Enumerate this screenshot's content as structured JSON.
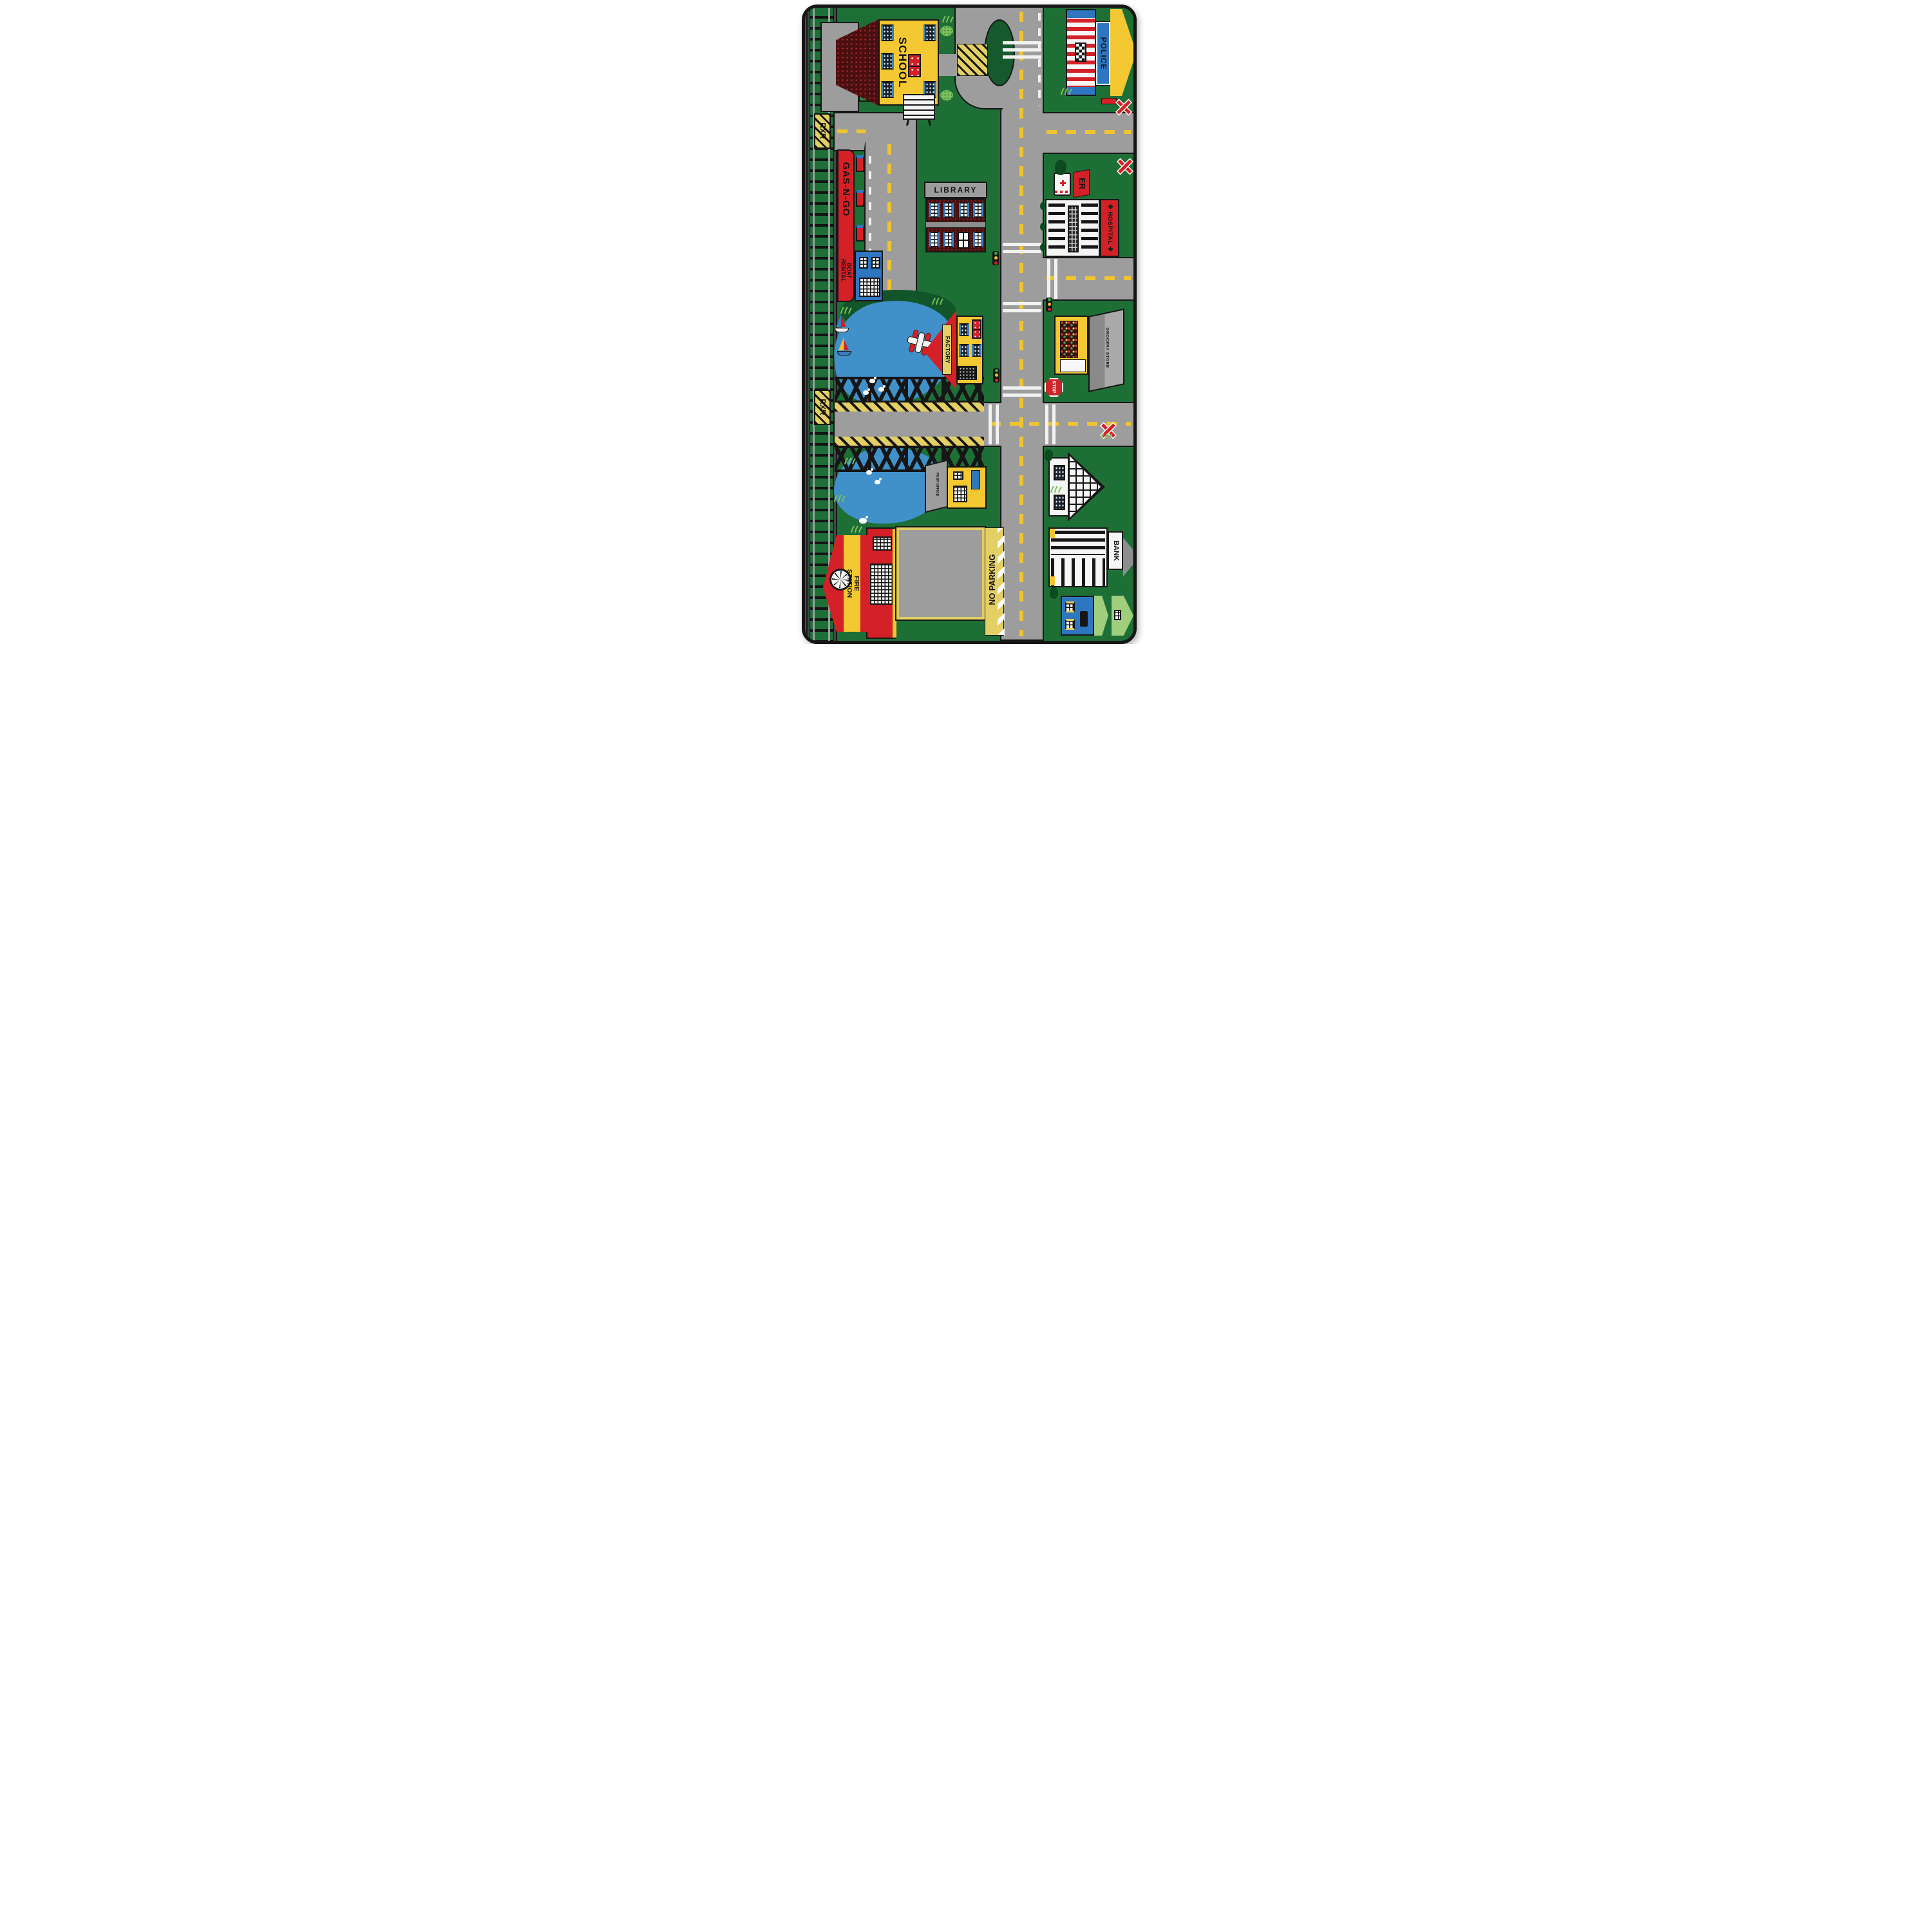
{
  "scene": {
    "description": "Product photo of a children's green city-road play rug on a white background, portrait orientation, rounded corners, black bound edge",
    "background_color": "#ffffff"
  },
  "palette": {
    "rug_green": "#1e6f36",
    "dark_green": "#0c4a20",
    "light_green_roof": "#9fce7c",
    "grass_green": "#7ec15a",
    "road_gray": "#9d9d9d",
    "platform_gray": "#8e8e8e",
    "yellow": "#f3c832",
    "marking_yellow": "#f0c430",
    "hatch_yellow": "#e3cf63",
    "red": "#d42127",
    "dark_red_roof": "#4a0f10",
    "brick_maroon": "#471111",
    "blue": "#2e77c0",
    "lake_blue": "#4090ca",
    "black": "#161616",
    "white": "#f5f5f5"
  },
  "labels": {
    "depot": "DEPOT",
    "rxr": "RXR",
    "school": "SCHOOL",
    "police": "POLICE",
    "library": "LIBRARY",
    "gas_station": "GAS-N-GO",
    "boat_rental": "BOAT RENTAL",
    "er": "ER",
    "hospital": "HOSPITAL",
    "hospital_cross": "✚",
    "factory": "FACTORY",
    "grocery": "GROCERY STORE",
    "stop": "STOP",
    "bank": "BANK",
    "post_office": "POST OFFICE",
    "fire_station": "FIRE STATION",
    "no_parking": "NO PARKING"
  }
}
